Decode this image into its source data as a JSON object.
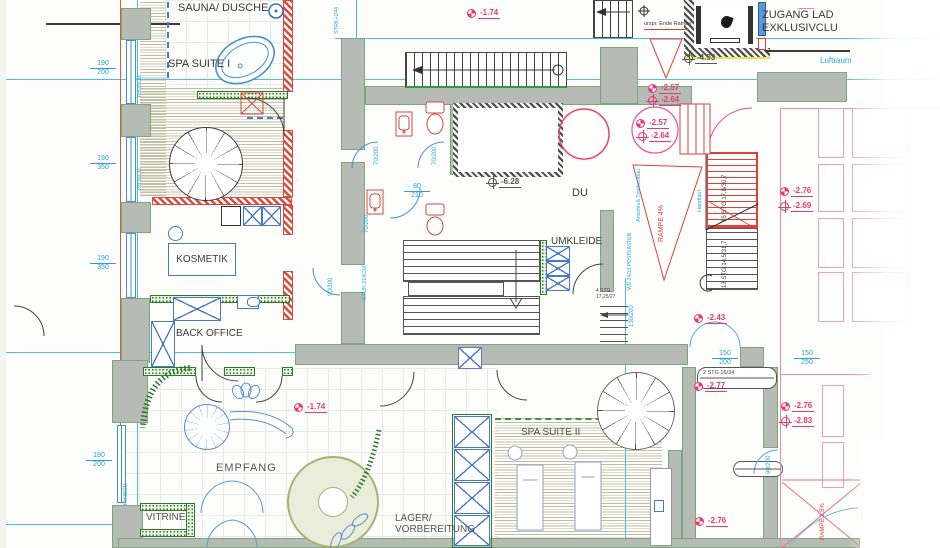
{
  "palette": {
    "wall_gray": "#b7bbb5",
    "hatch_red": "#dd4a3c",
    "marker_pink": "#e63976",
    "fixture_blue": "#4a90d0",
    "dim_cyan": "#2aa8dc",
    "wall_green": "#2c7a2c",
    "wood_olive": "#8b8d56"
  },
  "rooms": {
    "sauna": "SAUNA/ DUSCHE",
    "spa1": "SPA SUITE I",
    "kosmetik": "KOSMETIK",
    "back_office": "BACK OFFICE",
    "empfang": "EMPFANG",
    "vitrine": "VITRINE",
    "du": "DU",
    "umkleide": "UMKLEIDE",
    "spa2": "SPA SUITE II",
    "lager1": "LAGER/",
    "lager2": "VORBEREITUNG",
    "zugang1": "ZUGANG LAD",
    "zugang2": "EXKLUSIVCLU",
    "luftraum": "Luftraum"
  },
  "annotations": {
    "rampe4": "RAMPE 4%",
    "rampe25": "RAMPE 2,5%",
    "ende_rampe": "urspr. Ende Rampe",
    "handlauf": "Handlauf",
    "anschluss": "Anschluß Trockenbau",
    "postkaesten": "WD 24/13 POSTKÄSTEN",
    "strk": "STRK+244",
    "stuk": "STUK 215CM",
    "ph": "PH 85CM"
  },
  "stair_labels": {
    "s15": "15 STG 17,8/30,7",
    "s13": "13 STG 14,5/31,7",
    "s4a": "4 STG",
    "s4b": "17,25/27",
    "s2": "2 STG 16/34"
  },
  "dims": [
    {
      "a": "190",
      "b": "200"
    },
    {
      "a": "190",
      "b": "350"
    },
    {
      "a": "190",
      "b": "350"
    },
    {
      "a": "190",
      "b": "200"
    },
    {
      "a": "150",
      "b": "200"
    },
    {
      "a": "150",
      "b": "250"
    },
    {
      "a": "80",
      "b": "210"
    }
  ],
  "door_dims": [
    "70/200",
    "70/200",
    "70/200",
    "90/200",
    "130/200",
    "90/200"
  ],
  "markers": [
    {
      "value": "-1.74",
      "style": "level"
    },
    {
      "value": "-4.93",
      "style": "cross-dark"
    },
    {
      "value": "-2.57",
      "style": "level"
    },
    {
      "value": "-2.64",
      "style": "cross"
    },
    {
      "value": "-2.57",
      "style": "level"
    },
    {
      "value": "-2.64",
      "style": "cross"
    },
    {
      "value": "-6.28",
      "style": "cross-dark"
    },
    {
      "value": "-2.76",
      "style": "level"
    },
    {
      "value": "-2.69",
      "style": "cross"
    },
    {
      "value": "-2.43",
      "style": "level"
    },
    {
      "value": "-2.77",
      "style": "level"
    },
    {
      "value": "-1.74",
      "style": "level"
    },
    {
      "value": "-2.76",
      "style": "level"
    },
    {
      "value": "-2.83",
      "style": "cross"
    },
    {
      "value": "-2.76",
      "style": "level"
    }
  ]
}
